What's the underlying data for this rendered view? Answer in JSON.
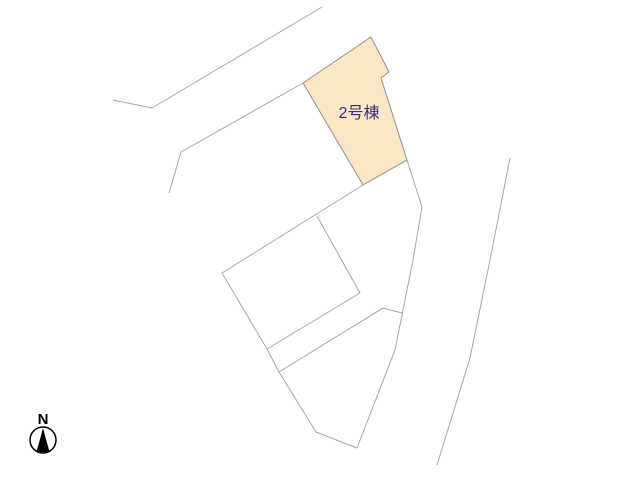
{
  "canvas": {
    "width": 640,
    "height": 480,
    "background": "#ffffff"
  },
  "colors": {
    "boundary_line": "#a6a6a6",
    "parcel_border": "#8f8f8f",
    "parcel_fill": "#fae7c3",
    "parcel_label": "#32327d",
    "compass": "#000000"
  },
  "site_plan": {
    "highlighted_parcel": {
      "label": "2号棟",
      "points": [
        [
          371,
          37
        ],
        [
          389,
          72
        ],
        [
          381,
          78
        ],
        [
          407,
          160
        ],
        [
          363,
          185
        ],
        [
          303,
          83
        ]
      ],
      "label_pos": {
        "x": 359,
        "y": 118
      },
      "label_font_size": 16
    },
    "boundary_lines": [
      {
        "name": "road-edge-upper",
        "points": [
          [
            113,
            100
          ],
          [
            152,
            108
          ],
          [
            322,
            7
          ]
        ]
      },
      {
        "name": "road-edge-lower",
        "points": [
          [
            169,
            193
          ],
          [
            181,
            152
          ],
          [
            303,
            83
          ]
        ]
      },
      {
        "name": "central-lot-boundary",
        "points": [
          [
            363,
            185
          ],
          [
            222,
            273
          ],
          [
            267,
            349
          ],
          [
            279,
            372
          ],
          [
            316,
            432
          ],
          [
            357,
            448
          ],
          [
            395,
            350
          ],
          [
            413,
            260
          ],
          [
            422,
            207
          ],
          [
            407,
            160
          ]
        ]
      },
      {
        "name": "building-pad",
        "points": [
          [
            317,
            216
          ],
          [
            360,
            293
          ],
          [
            267,
            349
          ]
        ]
      },
      {
        "name": "inner-lot-split",
        "points": [
          [
            279,
            372
          ],
          [
            383,
            308
          ],
          [
            402,
            313
          ]
        ]
      },
      {
        "name": "east-boundary",
        "points": [
          [
            510,
            158
          ],
          [
            490,
            260
          ],
          [
            470,
            358
          ],
          [
            437,
            465
          ]
        ]
      }
    ]
  },
  "compass": {
    "label": "N",
    "label_x": 43,
    "label_y": 424,
    "label_font_size": 15,
    "cx": 43,
    "cy": 440,
    "r": 13,
    "needle": [
      [
        43,
        428
      ],
      [
        36.5,
        452
      ],
      [
        49.5,
        452
      ]
    ]
  }
}
